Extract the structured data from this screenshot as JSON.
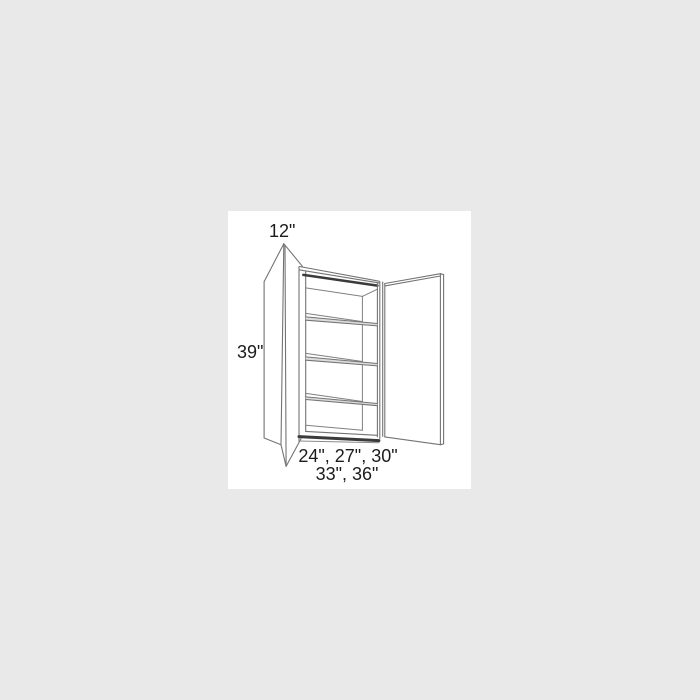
{
  "diagram": {
    "type": "line-drawing",
    "subject": "two-door wall cabinet shown with both doors open and three interior shelves",
    "labels": {
      "depth": "12\"",
      "height": "39\"",
      "widths_line1": "24\", 27\", 30\"",
      "widths_line2": "33\", 36\""
    },
    "colors": {
      "page_background": "#e9e9e9",
      "canvas_background": "#ffffff",
      "line": "#747474",
      "line_dark": "#3b3b3b",
      "shelf_band_shading": "#dcdcdc",
      "text": "#1c1c1c"
    }
  }
}
